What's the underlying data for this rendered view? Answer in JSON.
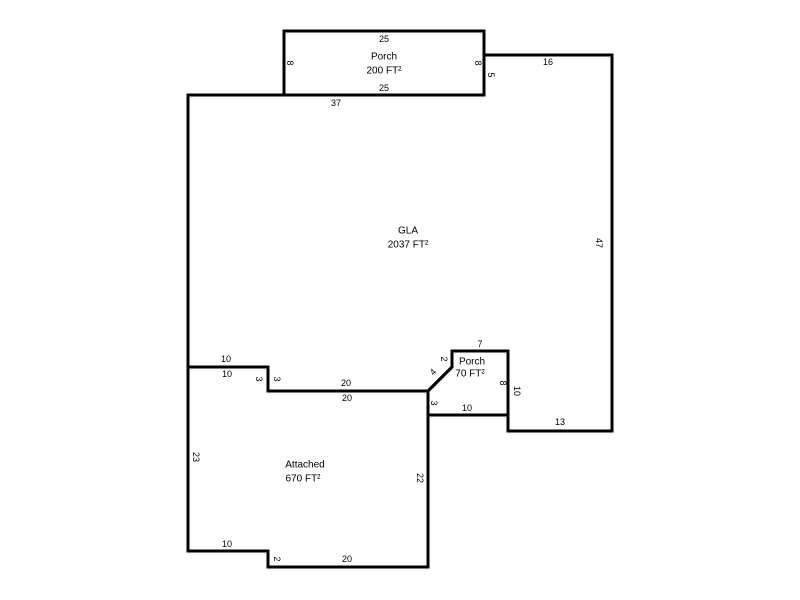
{
  "sketch": {
    "line_color": "#000000",
    "background": "#ffffff",
    "areas": {
      "porch_top": {
        "name": "Porch",
        "sqft": "200 FT²"
      },
      "gla": {
        "name": "GLA",
        "sqft": "2037 FT²"
      },
      "porch_small": {
        "name": "Porch",
        "sqft": "70 FT²"
      },
      "attached": {
        "name": "Attached",
        "sqft": "670 FT²"
      }
    },
    "dims": {
      "p200_top": "25",
      "p200_bottom": "25",
      "p200_left": "8",
      "p200_right": "8",
      "gla_top": "37",
      "gla_right_step": "5",
      "gla_top_right": "16",
      "gla_right": "47",
      "gla_bottom_right": "13",
      "gla_notch_right": "10",
      "gla_notch_top": "7",
      "gla_notch_left": "2",
      "gla_notch_diag": "4",
      "gla_bottom_left_10": "10",
      "gla_bottom_step_3": "3",
      "gla_bottom_20": "20",
      "att_top_10": "10",
      "att_top_step_3": "3",
      "att_top_20": "20",
      "p70_right": "8",
      "p70_bottom": "10",
      "p70_left": "3",
      "att_right": "22",
      "att_left": "23",
      "att_bottom_10": "10",
      "att_bottom_step_2": "2",
      "att_bottom_20": "20"
    }
  }
}
